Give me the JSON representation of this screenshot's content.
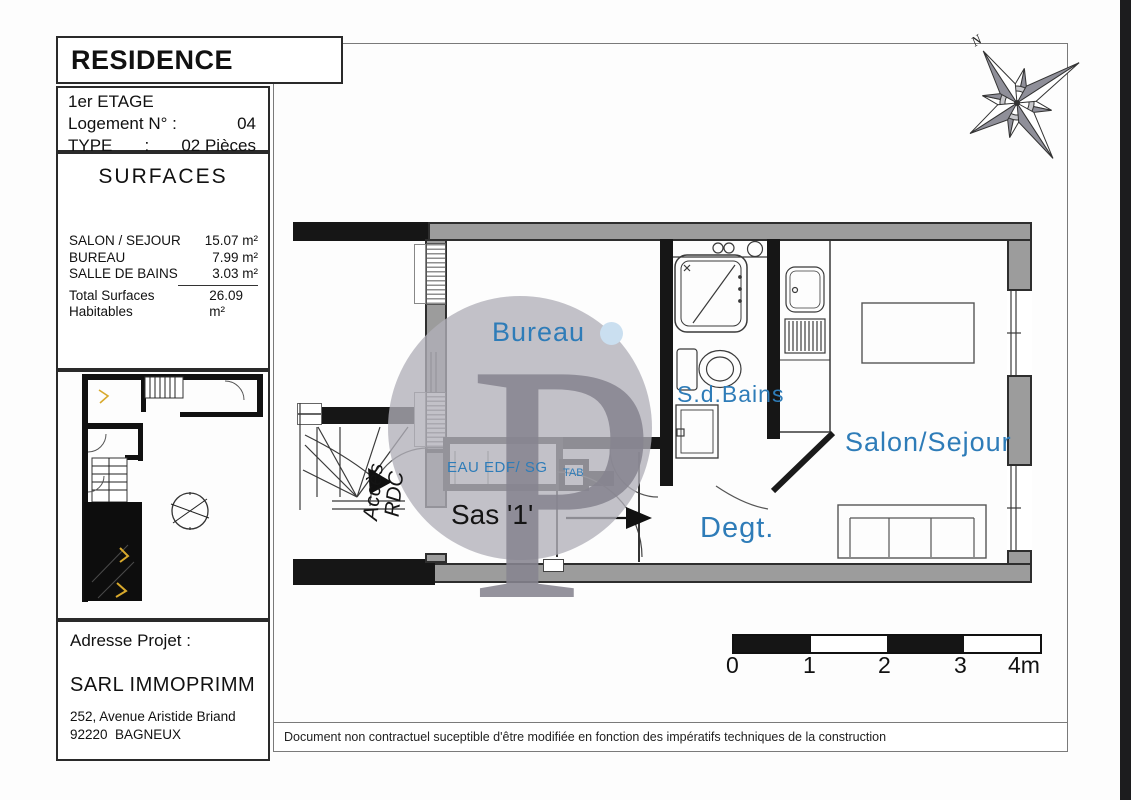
{
  "header": {
    "title": "RESIDENCE BAGNEUX",
    "floor": "1er ETAGE",
    "unit_label": "Logement N° :",
    "unit_number": "04",
    "type_label": "TYPE",
    "type_separator": ":",
    "type_value": "02 Pièces"
  },
  "surfaces": {
    "title": "SURFACES",
    "rows": [
      {
        "label": "SALON / SEJOUR",
        "value": "15.07 m²"
      },
      {
        "label": "BUREAU",
        "value": "7.99 m²"
      },
      {
        "label": "SALLE DE BAINS",
        "value": "3.03 m²"
      }
    ],
    "total": {
      "label": "Total Surfaces Habitables",
      "value": "26.09 m²"
    }
  },
  "address": {
    "heading": "Adresse Projet :",
    "company": "SARL IMMOPRIMM",
    "street": "252, Avenue Aristide Briand",
    "city": "92220  BAGNEUX"
  },
  "plan": {
    "room_labels": {
      "bureau": "Bureau",
      "bathroom": "S.d.Bains",
      "living": "Salon/Sejour",
      "hallway": "Degt.",
      "entry": "Sas '1'"
    },
    "annotations": {
      "access_line1": "Accès",
      "access_line2": "RDC",
      "utilities": "EAU EDF/ SG",
      "tab": "TAB"
    }
  },
  "compass": {
    "north": "N"
  },
  "watermark": {
    "letter": "P"
  },
  "scale_bar": {
    "ticks": [
      "0",
      "1",
      "2",
      "3"
    ],
    "end": "4m"
  },
  "footer": {
    "disclaimer": "Document non contractuel suceptible d'être modifiée en fonction des impératifs techniques de la construction"
  },
  "colors": {
    "label_blue": "#2e7cb8",
    "wall_gray": "#9c9c9c",
    "wall_black": "#161616",
    "watermark_circle": "#b1afb8",
    "watermark_letter": "#868490",
    "watermark_dot": "#cadff0",
    "accent_yellow": "#d8a92c"
  }
}
